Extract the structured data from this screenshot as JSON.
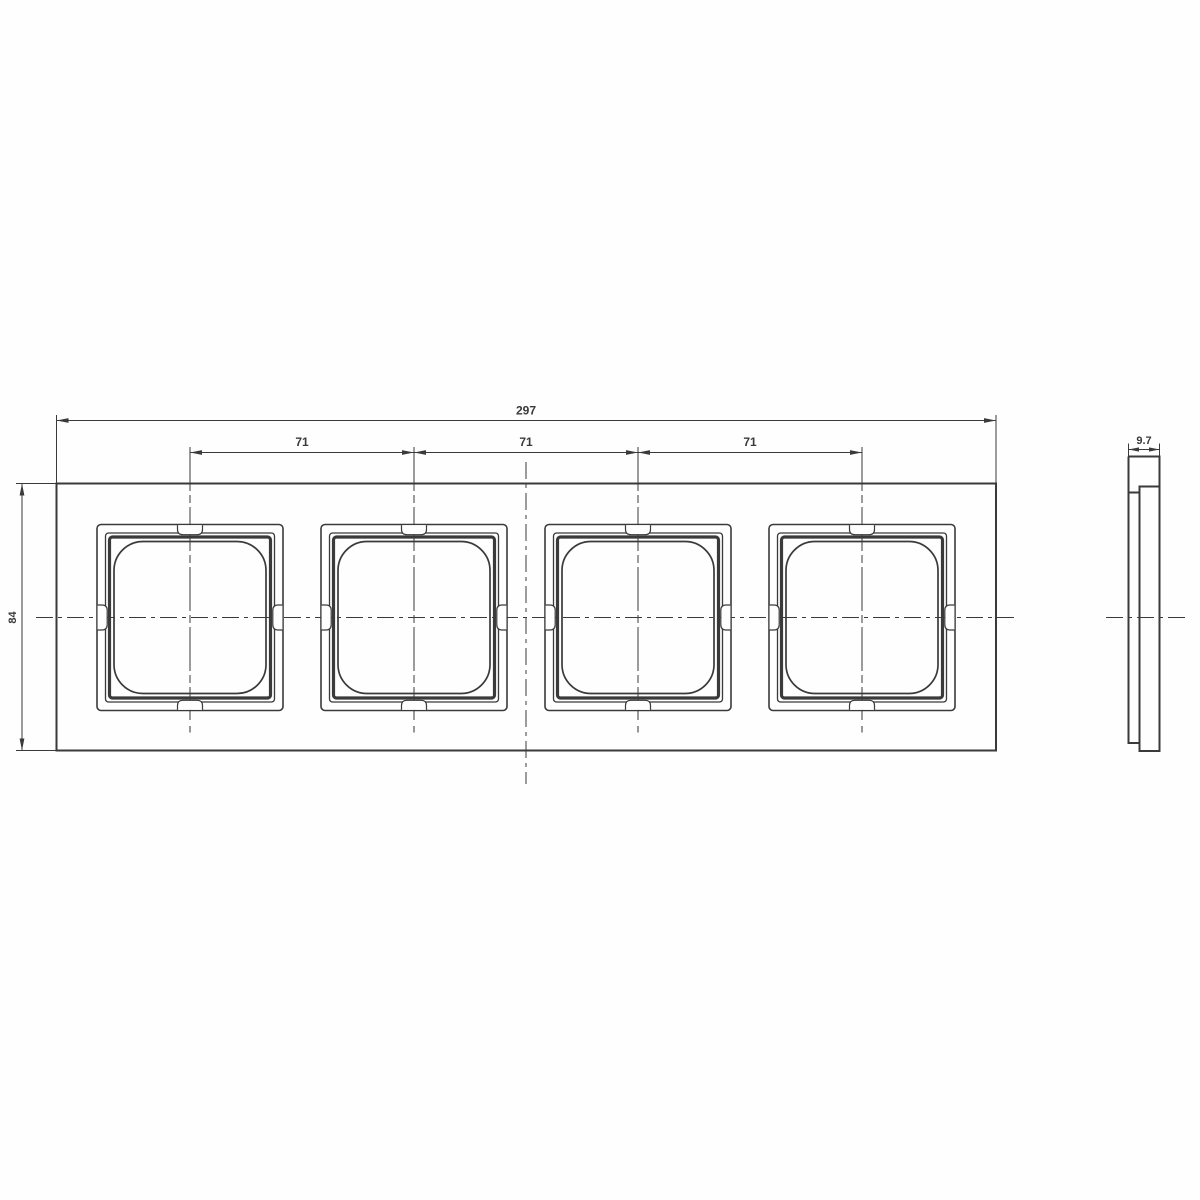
{
  "drawing": {
    "labels": {
      "total_width": "297",
      "pitch_1": "71",
      "pitch_2": "71",
      "pitch_3": "71",
      "height": "84",
      "depth": "9.7"
    },
    "front_view": {
      "opening_count": 4
    },
    "colors": {
      "line": "#3a3a3a",
      "background": "#fefefe"
    }
  }
}
